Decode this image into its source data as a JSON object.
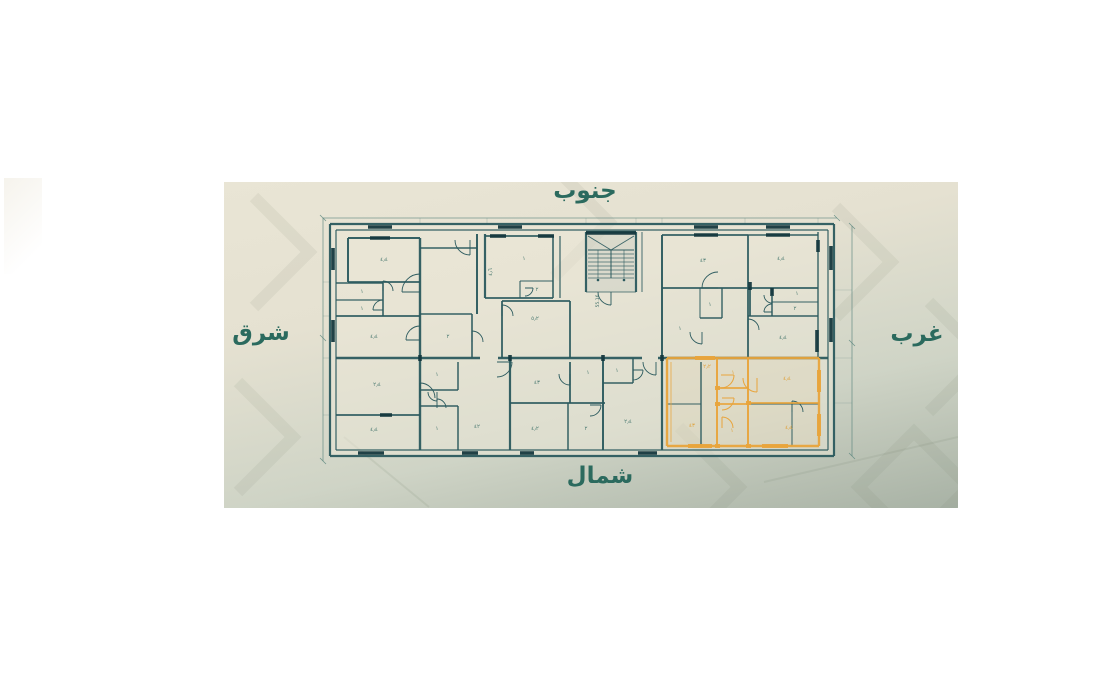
{
  "colors": {
    "wall": "#2b5a5e",
    "wallDark": "#15383e",
    "thin": "#5a857d",
    "orange": "#e8a43c",
    "tiny": "#4d7b72",
    "tinyOrange": "#dfa13a",
    "dirText": "#2b6a5e"
  },
  "directions": {
    "south": "جنوب",
    "north": "شمال",
    "east": "شرق",
    "west": "غرب"
  },
  "plan": {
    "fills": [
      [
        330,
        224,
        504,
        232,
        "#ebe7d8",
        0.5
      ],
      [
        586,
        232,
        50,
        60,
        "#2d5a5f",
        0.07
      ],
      [
        667,
        358,
        152,
        88,
        "#e8a43c",
        0.06
      ]
    ],
    "walls": [
      [
        330,
        224,
        834,
        224,
        2.2
      ],
      [
        330,
        456,
        834,
        456,
        2.2
      ],
      [
        330,
        224,
        330,
        456,
        2.2
      ],
      [
        834,
        224,
        834,
        456,
        2.2
      ],
      [
        336,
        230,
        828,
        230,
        1.2
      ],
      [
        336,
        450,
        828,
        450,
        1.2
      ],
      [
        336,
        230,
        336,
        450,
        1.2
      ],
      [
        828,
        230,
        828,
        450,
        1.2
      ],
      [
        348,
        238,
        420,
        238,
        2
      ],
      [
        348,
        238,
        348,
        282,
        2
      ],
      [
        348,
        282,
        420,
        282,
        1.8
      ],
      [
        336,
        283,
        383,
        283,
        1.6
      ],
      [
        336,
        300,
        383,
        300,
        1.3
      ],
      [
        383,
        283,
        383,
        316,
        1.6
      ],
      [
        336,
        316,
        420,
        316,
        1.8
      ],
      [
        420,
        238,
        420,
        358,
        2.4
      ],
      [
        420,
        248,
        477,
        248,
        1.6
      ],
      [
        477,
        234,
        477,
        314,
        2
      ],
      [
        420,
        314,
        472,
        314,
        1.4
      ],
      [
        472,
        314,
        472,
        358,
        1.6
      ],
      [
        485,
        234,
        485,
        298,
        2.2
      ],
      [
        485,
        236,
        553,
        236,
        1.8
      ],
      [
        485,
        298,
        553,
        298,
        1.8
      ],
      [
        553,
        236,
        553,
        298,
        1.6
      ],
      [
        560,
        236,
        560,
        298,
        1.2
      ],
      [
        520,
        281,
        553,
        281,
        1.1
      ],
      [
        520,
        281,
        520,
        298,
        1.1
      ],
      [
        502,
        301,
        570,
        301,
        1.8
      ],
      [
        502,
        301,
        502,
        358,
        1.8
      ],
      [
        570,
        301,
        570,
        358,
        1.8
      ],
      [
        586,
        232,
        636,
        232,
        2.4
      ],
      [
        586,
        232,
        586,
        292,
        2.2
      ],
      [
        636,
        232,
        636,
        292,
        2.2
      ],
      [
        642,
        232,
        642,
        292,
        0.9
      ],
      [
        586,
        292,
        636,
        292,
        0.8
      ],
      [
        662,
        235,
        748,
        235,
        1.8
      ],
      [
        662,
        235,
        662,
        358,
        2
      ],
      [
        748,
        235,
        748,
        316,
        1.8
      ],
      [
        748,
        235,
        818,
        235,
        1.6
      ],
      [
        818,
        232,
        818,
        358,
        1.4
      ],
      [
        662,
        288,
        818,
        288,
        1.8
      ],
      [
        750,
        288,
        750,
        316,
        1.8
      ],
      [
        772,
        288,
        772,
        316,
        1.5
      ],
      [
        772,
        302,
        818,
        302,
        1.1
      ],
      [
        748,
        316,
        818,
        316,
        1.6
      ],
      [
        722,
        288,
        722,
        318,
        1.4
      ],
      [
        700,
        318,
        722,
        318,
        1.4
      ],
      [
        700,
        288,
        700,
        318,
        1.0
      ],
      [
        748,
        316,
        748,
        358,
        1.8
      ],
      [
        336,
        358,
        480,
        358,
        2.6
      ],
      [
        498,
        358,
        642,
        358,
        2.6
      ],
      [
        658,
        358,
        828,
        358,
        2.6
      ],
      [
        420,
        358,
        420,
        450,
        2.4
      ],
      [
        336,
        415,
        420,
        415,
        1.8
      ],
      [
        420,
        390,
        458,
        390,
        1.5
      ],
      [
        458,
        362,
        458,
        390,
        1.5
      ],
      [
        420,
        406,
        458,
        406,
        1.5
      ],
      [
        458,
        406,
        458,
        450,
        1.5
      ],
      [
        510,
        358,
        510,
        450,
        2.2
      ],
      [
        570,
        362,
        570,
        403,
        1.8
      ],
      [
        510,
        403,
        605,
        403,
        1.8
      ],
      [
        568,
        403,
        568,
        450,
        1.5
      ],
      [
        603,
        358,
        603,
        450,
        2
      ],
      [
        603,
        383,
        633,
        383,
        1.5
      ],
      [
        633,
        358,
        633,
        383,
        1.5
      ],
      [
        662,
        358,
        662,
        450,
        2.2
      ],
      [
        701,
        362,
        701,
        446,
        1.4
      ],
      [
        667,
        404,
        701,
        404,
        1.1
      ],
      [
        792,
        404,
        792,
        446,
        1.0
      ],
      [
        748,
        404,
        819,
        404,
        1.0
      ]
    ],
    "dark_marks": [
      [
        368,
        227,
        392,
        227
      ],
      [
        498,
        227,
        522,
        227
      ],
      [
        694,
        227,
        718,
        227
      ],
      [
        766,
        227,
        790,
        227
      ],
      [
        370,
        238,
        390,
        238
      ],
      [
        490,
        236,
        506,
        236
      ],
      [
        538,
        236,
        554,
        236
      ],
      [
        694,
        235,
        718,
        235
      ],
      [
        766,
        235,
        790,
        235
      ],
      [
        333,
        248,
        333,
        270
      ],
      [
        333,
        320,
        333,
        342
      ],
      [
        831,
        246,
        831,
        270
      ],
      [
        831,
        318,
        831,
        342
      ],
      [
        358,
        453,
        384,
        453
      ],
      [
        462,
        453,
        478,
        453
      ],
      [
        520,
        453,
        534,
        453
      ],
      [
        638,
        453,
        657,
        453
      ],
      [
        380,
        415,
        392,
        415
      ],
      [
        586,
        233,
        636,
        233
      ],
      [
        750,
        282,
        750,
        290
      ],
      [
        772,
        288,
        772,
        296
      ],
      [
        817,
        330,
        817,
        352
      ],
      [
        818,
        240,
        818,
        252
      ],
      [
        420,
        355,
        420,
        361
      ],
      [
        510,
        355,
        510,
        361
      ],
      [
        603,
        355,
        603,
        361
      ],
      [
        662,
        355,
        662,
        361
      ]
    ],
    "thin_lines": [
      [
        323,
        218,
        837,
        218
      ],
      [
        323,
        218,
        323,
        461
      ],
      [
        852,
        226,
        852,
        456
      ],
      [
        320,
        215,
        326,
        221
      ],
      [
        834,
        215,
        840,
        221
      ],
      [
        320,
        335,
        326,
        341
      ],
      [
        320,
        458,
        326,
        464
      ],
      [
        849,
        223,
        855,
        229
      ],
      [
        849,
        340,
        855,
        346
      ],
      [
        849,
        453,
        855,
        459
      ]
    ],
    "faint_lines": [
      [
        420,
        218,
        420,
        224
      ],
      [
        487,
        218,
        487,
        224
      ],
      [
        586,
        218,
        586,
        224
      ],
      [
        636,
        218,
        636,
        224
      ],
      [
        662,
        218,
        662,
        224
      ],
      [
        745,
        218,
        745,
        224
      ],
      [
        818,
        218,
        818,
        224
      ],
      [
        323,
        282,
        330,
        282
      ],
      [
        323,
        316,
        330,
        316
      ],
      [
        323,
        358,
        330,
        358
      ],
      [
        323,
        415,
        330,
        415
      ],
      [
        834,
        358,
        852,
        358
      ],
      [
        834,
        403,
        852,
        403
      ],
      [
        834,
        290,
        852,
        290
      ]
    ],
    "doors": [
      [
        420,
        292,
        18,
        180,
        270
      ],
      [
        383,
        291,
        10,
        270,
        360
      ],
      [
        383,
        310,
        10,
        180,
        270
      ],
      [
        420,
        340,
        14,
        180,
        270
      ],
      [
        470,
        240,
        15,
        90,
        180
      ],
      [
        525,
        288,
        8,
        0,
        90
      ],
      [
        502,
        316,
        11,
        270,
        360
      ],
      [
        718,
        288,
        16,
        180,
        270
      ],
      [
        702,
        332,
        12,
        90,
        180
      ],
      [
        772,
        295,
        8,
        90,
        180
      ],
      [
        772,
        312,
        8,
        180,
        270
      ],
      [
        748,
        330,
        11,
        270,
        360
      ],
      [
        420,
        398,
        15,
        270,
        360
      ],
      [
        437,
        392,
        9,
        90,
        180
      ],
      [
        437,
        408,
        9,
        270,
        360
      ],
      [
        497,
        362,
        15,
        0,
        90
      ],
      [
        570,
        374,
        11,
        90,
        180
      ],
      [
        590,
        405,
        11,
        0,
        90
      ],
      [
        633,
        370,
        10,
        0,
        90
      ],
      [
        656,
        362,
        13,
        90,
        180
      ],
      [
        792,
        412,
        11,
        270,
        360
      ],
      [
        472,
        342,
        11,
        270,
        360
      ],
      [
        611,
        292,
        13,
        90,
        180
      ]
    ],
    "orange_walls": [
      [
        667,
        358,
        819,
        358,
        2.4
      ],
      [
        667,
        446,
        819,
        446,
        2.4
      ],
      [
        667,
        358,
        667,
        446,
        2.4
      ],
      [
        819,
        358,
        819,
        446,
        2.4
      ],
      [
        717,
        358,
        717,
        446,
        2
      ],
      [
        748,
        358,
        748,
        446,
        2
      ],
      [
        717,
        388,
        748,
        388,
        1.8
      ],
      [
        717,
        404,
        748,
        404,
        1.8
      ],
      [
        748,
        403,
        819,
        403,
        1.8
      ],
      [
        671,
        362,
        671,
        442,
        0.8
      ]
    ],
    "orange_marks": [
      [
        688,
        446,
        712,
        446
      ],
      [
        762,
        446,
        788,
        446
      ],
      [
        819,
        370,
        819,
        392
      ],
      [
        819,
        414,
        819,
        436
      ],
      [
        695,
        358,
        715,
        358
      ],
      [
        715,
        388,
        720,
        388
      ],
      [
        715,
        404,
        720,
        404
      ],
      [
        746,
        403,
        751,
        403
      ],
      [
        746,
        446,
        751,
        446
      ],
      [
        715,
        446,
        720,
        446
      ]
    ],
    "orange_doors": [
      [
        721,
        375,
        13,
        0,
        90
      ],
      [
        722,
        398,
        12,
        0,
        90
      ],
      [
        722,
        428,
        11,
        270,
        360
      ],
      [
        757,
        378,
        14,
        90,
        180
      ]
    ],
    "stair": {
      "x": 586,
      "y": 232,
      "w": 50,
      "h": 60,
      "tread_y": 250,
      "tread_end": 278,
      "treads": 8,
      "cx": 611,
      "rails": [
        598,
        624
      ],
      "label": "55.16",
      "label_x": 599,
      "label_y": 301
    },
    "labels": [
      [
        384,
        261,
        "٤٫٤",
        0
      ],
      [
        362,
        293,
        "١",
        0
      ],
      [
        362,
        310,
        "١",
        0
      ],
      [
        374,
        338,
        "٤٫٤",
        0
      ],
      [
        492,
        272,
        "٤٫٦",
        -90
      ],
      [
        448,
        338,
        "٢",
        0
      ],
      [
        524,
        260,
        "١",
        0
      ],
      [
        537,
        291,
        "٢",
        0
      ],
      [
        535,
        320,
        "٥٫٢",
        0
      ],
      [
        703,
        262,
        "٤٣",
        0
      ],
      [
        781,
        260,
        "٤٫٤",
        0
      ],
      [
        797,
        295,
        "١",
        0
      ],
      [
        795,
        310,
        "٢",
        0
      ],
      [
        783,
        339,
        "٤٫٤",
        0
      ],
      [
        680,
        330,
        "١",
        0
      ],
      [
        710,
        306,
        "١",
        0
      ],
      [
        377,
        386,
        "٢٫٤",
        0
      ],
      [
        374,
        431,
        "٤٫٤",
        0
      ],
      [
        437,
        376,
        "١",
        0
      ],
      [
        437,
        430,
        "١",
        0
      ],
      [
        477,
        428,
        "٤٢",
        0
      ],
      [
        537,
        384,
        "٤٣",
        0
      ],
      [
        535,
        430,
        "٤٫٢",
        0
      ],
      [
        588,
        374,
        "١",
        0
      ],
      [
        586,
        430,
        "٢",
        0
      ],
      [
        617,
        372,
        "١",
        0
      ],
      [
        628,
        423,
        "٢٫٤",
        0
      ]
    ],
    "orange_labels": [
      [
        707,
        368,
        "٢٫٢",
        0
      ],
      [
        692,
        427,
        "٤٣",
        0
      ],
      [
        733,
        374,
        "١",
        0
      ],
      [
        732,
        432,
        "١",
        0
      ],
      [
        787,
        380,
        "٤٫٤",
        0
      ],
      [
        789,
        429,
        "٤٫٤",
        0
      ]
    ]
  }
}
